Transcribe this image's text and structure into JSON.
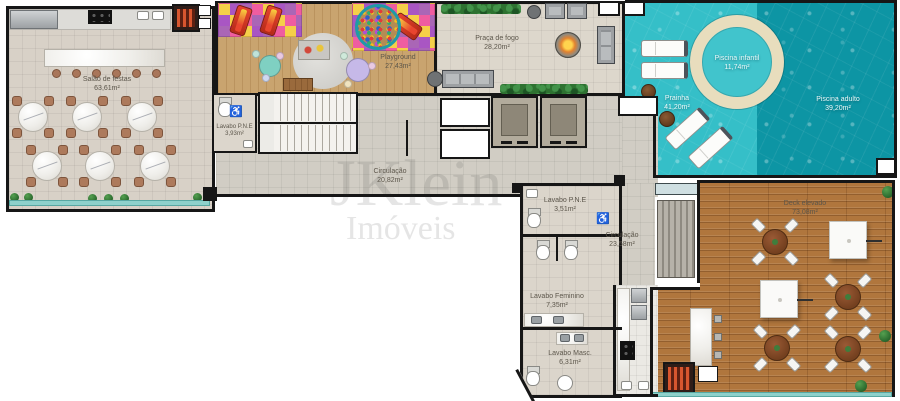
{
  "watermark": {
    "brand": "JKlein",
    "subtitle": "Imóveis"
  },
  "icons": {
    "wheelchair": "♿"
  },
  "rooms": {
    "salao": {
      "name": "Salão de festas",
      "area": "63,61m²"
    },
    "playground": {
      "name": "Playground",
      "area": "27,43m²"
    },
    "praca_fogo": {
      "name": "Praça de fogo",
      "area": "28,20m²"
    },
    "lavabo_pne_1": {
      "name": "Lavabo P.N.E",
      "area": "3,93m²"
    },
    "circulacao_1": {
      "name": "Circulação",
      "area": "20,82m²"
    },
    "piscina_infantil": {
      "name": "Piscina infantil",
      "area": "11,74m²"
    },
    "prainha": {
      "name": "Prainha",
      "area": "41,20m²"
    },
    "piscina_adulto": {
      "name": "Piscina adulto",
      "area": "39,20m²"
    },
    "lavabo_pne_2": {
      "name": "Lavabo P.N.E",
      "area": "3,51m²"
    },
    "circulacao_2": {
      "name": "Circulação",
      "area": "23,58m²"
    },
    "lavabo_feminino": {
      "name": "Lavabo Feminino",
      "area": "7,35m²"
    },
    "lavabo_masc": {
      "name": "Lavabo Masc.",
      "area": "6,31m²"
    },
    "deck": {
      "name": "Deck elevado",
      "area": "73,08m²"
    }
  },
  "colors": {
    "wall": "#161616",
    "pool_light": "#35bfc8",
    "pool_dark": "#0d95a4",
    "sand_ring": "#e8ddbd",
    "deck_wood": "#b0763d",
    "play_wood": "#c9a46f",
    "floor_beige": "#d8d1c7",
    "floor_gray": "#d1cdc4",
    "hedge_green": "#2e7231",
    "glass_teal": "#8ed1cb"
  }
}
